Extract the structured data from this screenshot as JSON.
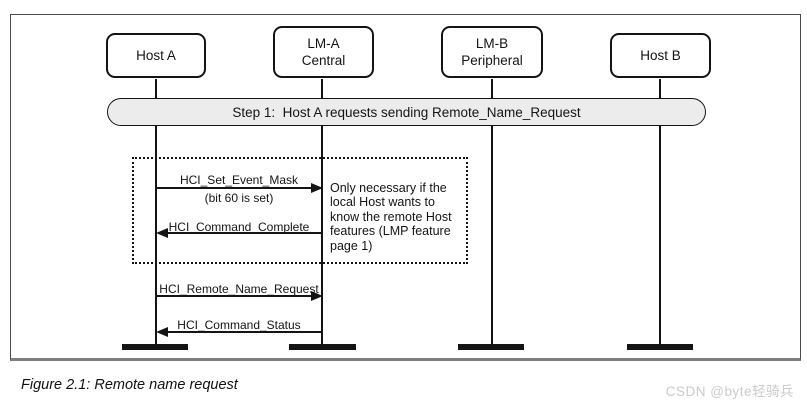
{
  "figure": {
    "caption": "Figure 2.1: Remote name request",
    "watermark": "CSDN @byte轻骑兵"
  },
  "diagram": {
    "step_banner": "Step 1:  Host A requests sending Remote_Name_Request",
    "actors": [
      {
        "line1": "Host A"
      },
      {
        "line1": "LM-A",
        "line2": "Central"
      },
      {
        "line1": "LM-B",
        "line2": "Peripheral"
      },
      {
        "line1": "Host B"
      }
    ],
    "messages": [
      {
        "label": "HCI_Set_Event_Mask",
        "sublabel": "(bit 60 is set)",
        "direction": "right"
      },
      {
        "label": "HCI_Command_Complete",
        "direction": "left"
      },
      {
        "label": "HCI_Remote_Name_Request",
        "direction": "right"
      },
      {
        "label": "HCI_Command_Status",
        "direction": "left"
      }
    ],
    "note_lines": [
      "Only necessary if the",
      "local Host wants to",
      "know the remote Host",
      "features (LMP feature",
      "page 1)"
    ],
    "colors": {
      "banner_fill": "#ececec",
      "ink": "#141414",
      "frame_border": "#4a4a4a",
      "frame_shadow": "#7e7e7e",
      "watermark": "#cbcbcb"
    }
  }
}
